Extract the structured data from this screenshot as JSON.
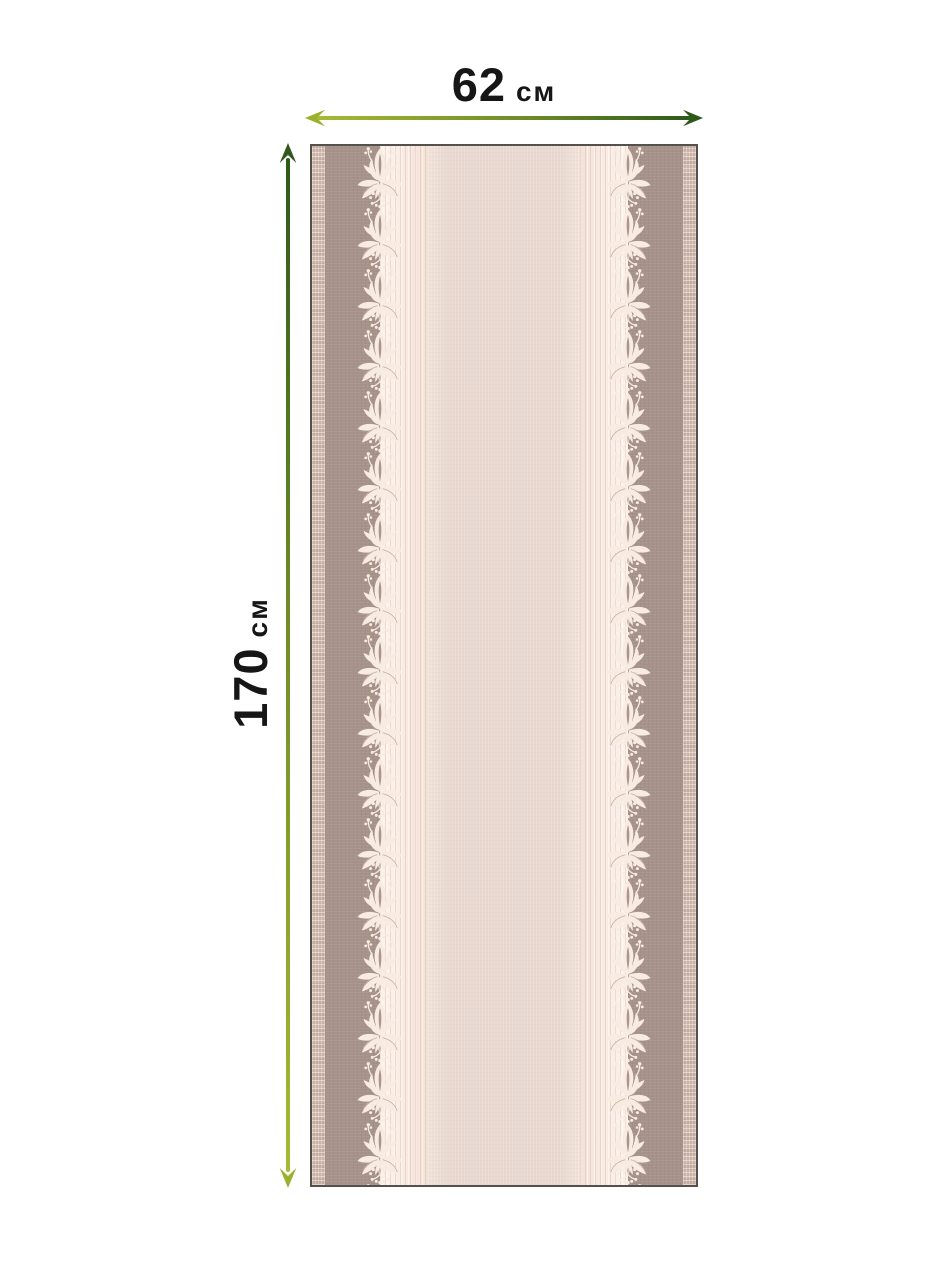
{
  "product_diagram": {
    "width_label": {
      "value": "62",
      "unit": "см"
    },
    "height_label": {
      "value": "170",
      "unit": "см"
    }
  },
  "arrows": {
    "horizontal_arrow": {
      "from_color": "#9cb02e",
      "to_color": "#2d591b",
      "direction": "left-to-right"
    },
    "vertical_arrow": {
      "from_color": "#2e5b1c",
      "to_color": "#9cb02e",
      "direction": "top-to-bottom"
    }
  },
  "fabric_swatch": {
    "pattern": "striped runner with mirrored damask floral border columns",
    "palette": {
      "selvage": "#c9b3a9",
      "taupe_band": "#a6928b",
      "cream_band": "#f9ece4",
      "center_panel": "#e9d8d0",
      "floral_motif": "#f7ebe2",
      "edge_line": "#54504b"
    }
  }
}
